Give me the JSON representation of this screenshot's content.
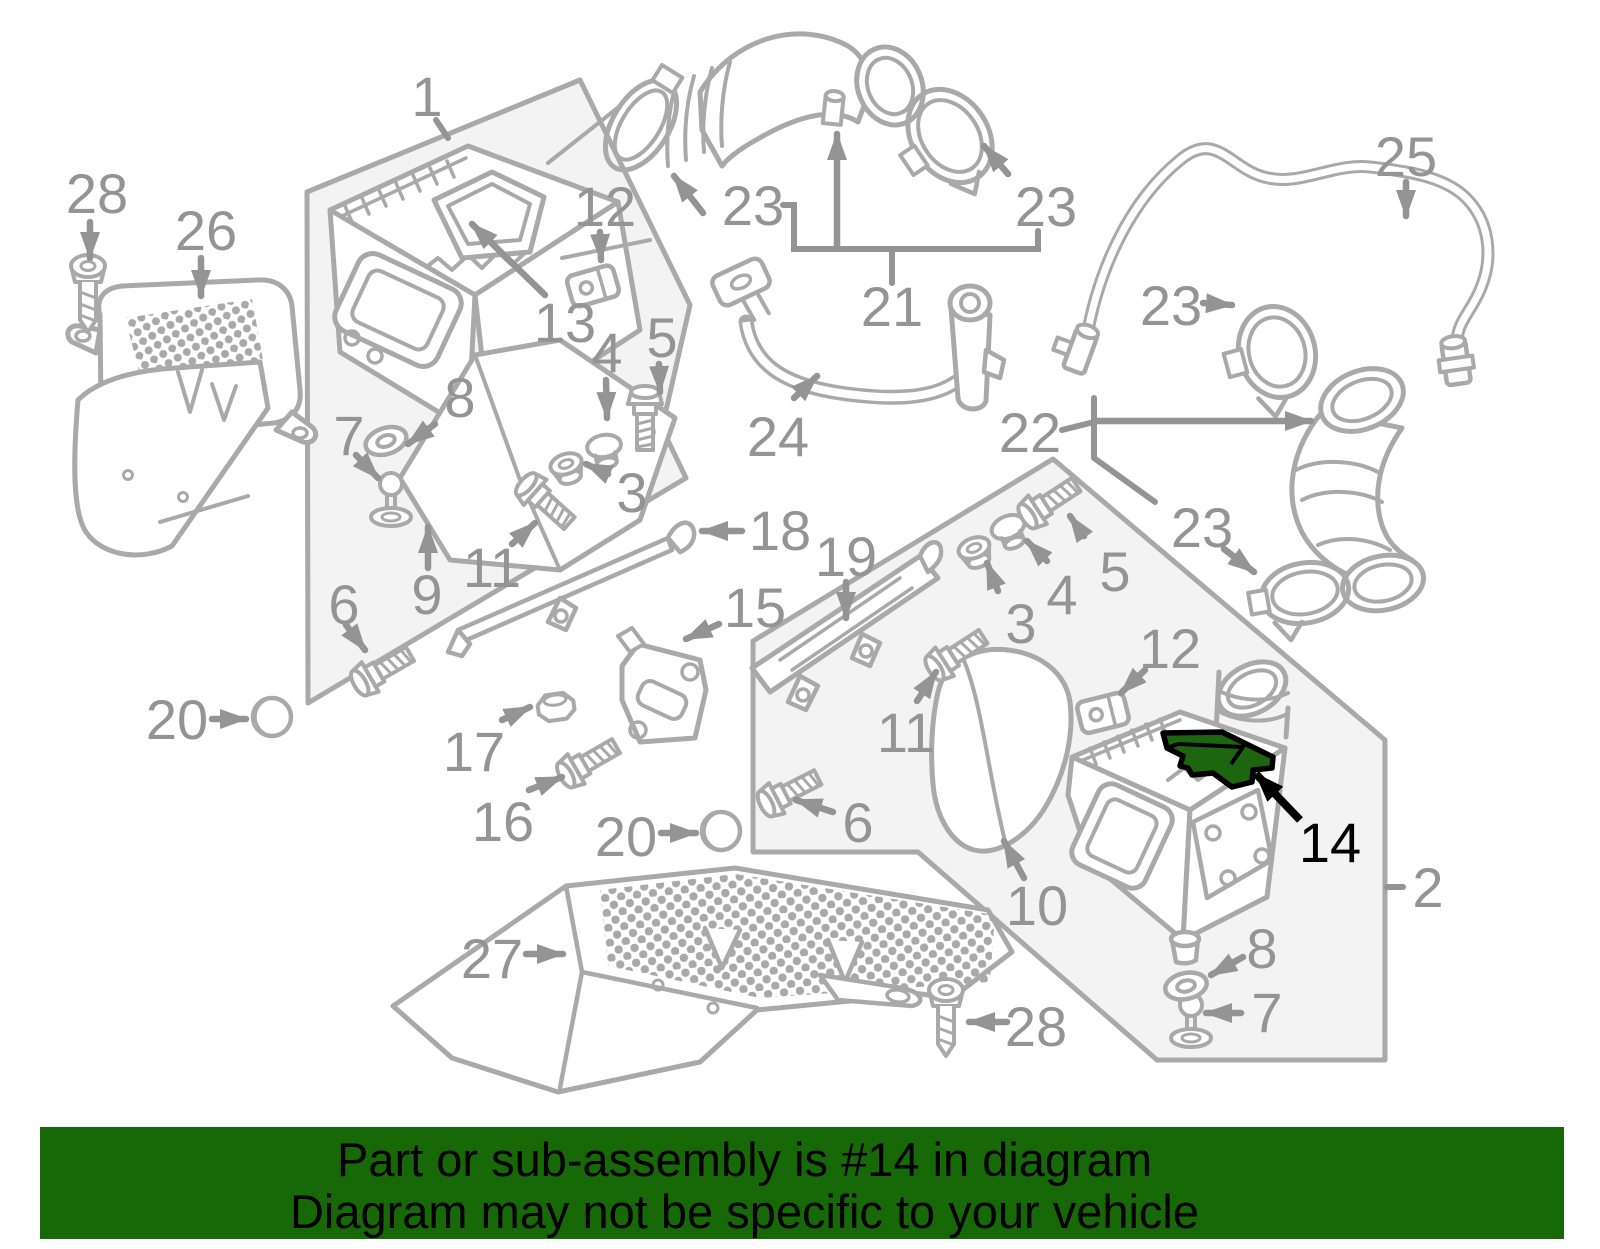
{
  "colors": {
    "line": "#a9a9a9",
    "label": "#949494",
    "ink": "#000000",
    "panel": "#f3f3f3",
    "highlight": "#1e650f",
    "banner-bg": "#176908",
    "banner-text": "#000000"
  },
  "banner": {
    "line1": "Part or sub-assembly is #14 in diagram",
    "line2": "Diagram may not be specific to your vehicle"
  },
  "highlighted_part_number": "14",
  "callouts": {
    "c1": "1",
    "c2": "2",
    "c3l": "3",
    "c3r": "3",
    "c4l": "4",
    "c4r": "4",
    "c5l": "5",
    "c5r": "5",
    "c6l": "6",
    "c6b": "6",
    "c7l": "7",
    "c7r": "7",
    "c8l": "8",
    "c8r": "8",
    "c9": "9",
    "c10": "10",
    "c11l": "11",
    "c11r": "11",
    "c12l": "12",
    "c12r": "12",
    "c13": "13",
    "c14": "14",
    "c15": "15",
    "c16": "16",
    "c17": "17",
    "c18": "18",
    "c19": "19",
    "c20l": "20",
    "c20b": "20",
    "c21": "21",
    "c22": "22",
    "c23a": "23",
    "c23b": "23",
    "c23c": "23",
    "c23d": "23",
    "c24": "24",
    "c25": "25",
    "c26": "26",
    "c27": "27",
    "c28a": "28",
    "c28b": "28"
  }
}
